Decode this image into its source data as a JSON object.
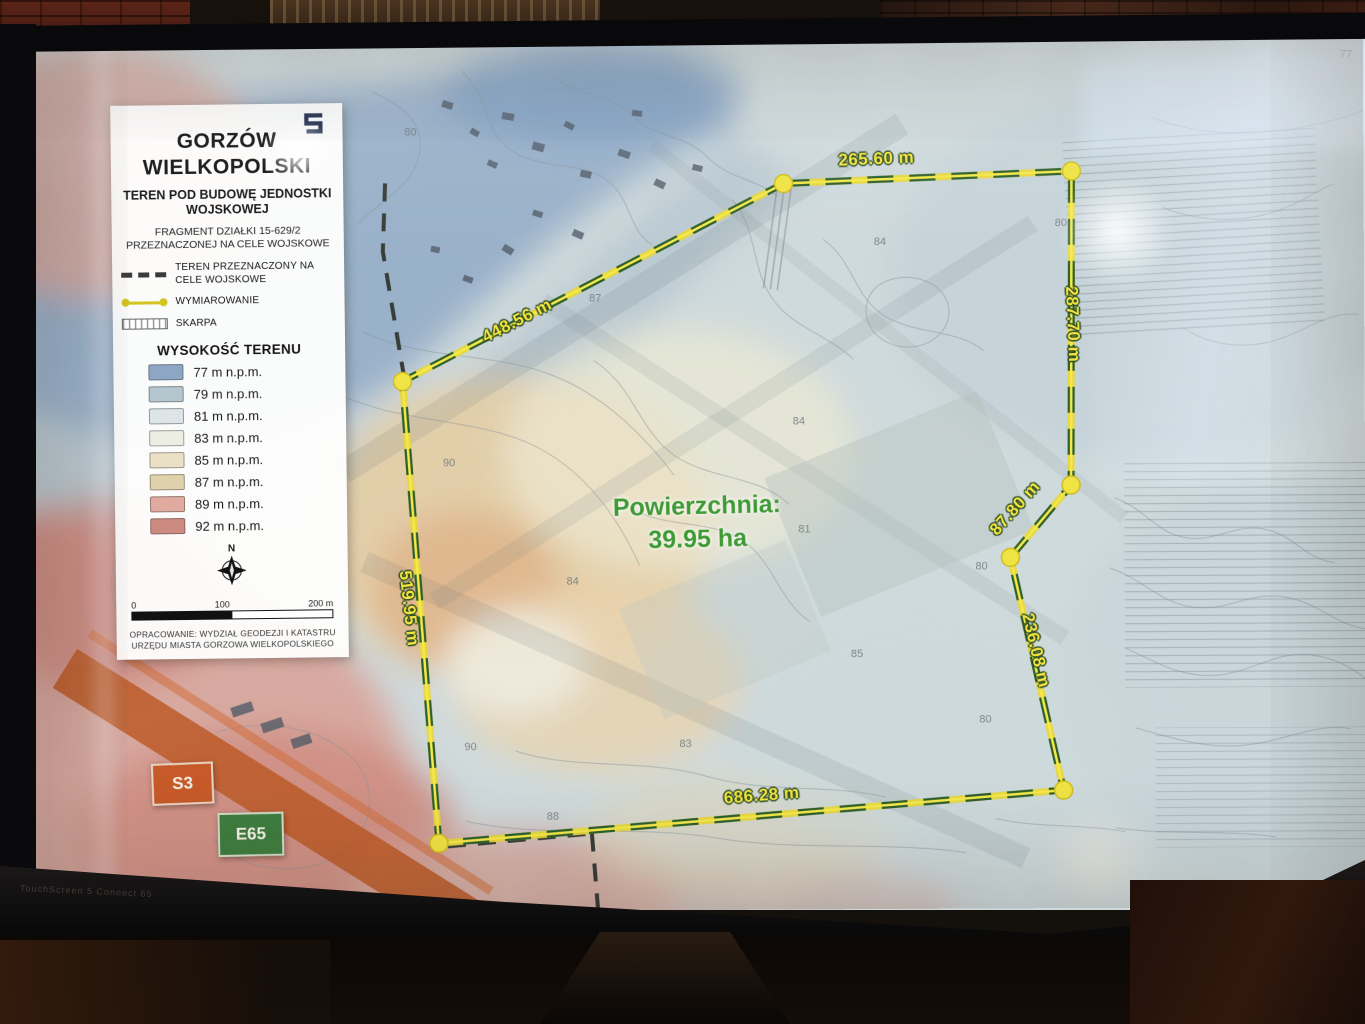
{
  "colors": {
    "accent-yellow": "#f2e340",
    "boundary-green": "#2d5f2d",
    "area-green": "#3e9b36"
  },
  "screen_device": {
    "bezel_text": "TouchScreen 5 Connect 65"
  },
  "title_card": {
    "logo": "S",
    "city_name": "GORZÓW WIELKOPOLSKI",
    "subtitle": "TEREN POD BUDOWĘ JEDNOSTKI WOJSKOWEJ",
    "fragment": "FRAGMENT DZIAŁKI 15-629/2 PRZEZNACZONEJ NA CELE WOJSKOWE",
    "legend": [
      {
        "symbol": "dashed-boundary-line",
        "label": "TEREN PRZEZNACZONY NA CELE WOJSKOWE"
      },
      {
        "symbol": "dimension-line",
        "label": "WYMIAROWANIE"
      },
      {
        "symbol": "hatched-bar",
        "label": "SKARPA"
      }
    ],
    "elevation_title": "WYSOKOŚĆ TERENU",
    "elevations": [
      {
        "label": "77 m n.p.m.",
        "color": "#8ca6c4"
      },
      {
        "label": "79 m n.p.m.",
        "color": "#b6c6ce"
      },
      {
        "label": "81 m n.p.m.",
        "color": "#dde5e7"
      },
      {
        "label": "83 m n.p.m.",
        "color": "#edeee3"
      },
      {
        "label": "85 m n.p.m.",
        "color": "#eae0c5"
      },
      {
        "label": "87 m n.p.m.",
        "color": "#e0d1ad"
      },
      {
        "label": "89 m n.p.m.",
        "color": "#e0aa9f"
      },
      {
        "label": "92 m n.p.m.",
        "color": "#cd8a80"
      }
    ],
    "compass_label": "N",
    "scale": {
      "start": "0",
      "mid": "100",
      "end": "200 m"
    },
    "attribution": "OPRACOWANIE: WYDZIAŁ GEODEZJI I KATASTRU URZĘDU MIASTA GORZOWA WIELKOPOLSKIEGO"
  },
  "map": {
    "area_label": "Powierzchnia:",
    "area_value": "39.95 ha",
    "dimensions": [
      {
        "label": "265.60 m"
      },
      {
        "label": "287.70 m"
      },
      {
        "label": "87.80 m"
      },
      {
        "label": "236.08 m"
      },
      {
        "label": "686.28 m"
      },
      {
        "label": "519.95 m"
      },
      {
        "label": "448.56 m"
      }
    ],
    "road_badges": [
      {
        "label": "S3",
        "color": "#c65a28"
      },
      {
        "label": "E65",
        "color": "#3f7d3f"
      }
    ],
    "contour_labels": [
      "80",
      "87",
      "84",
      "80",
      "84",
      "81",
      "90",
      "84",
      "80",
      "85",
      "83",
      "80",
      "90",
      "88",
      "77"
    ]
  }
}
